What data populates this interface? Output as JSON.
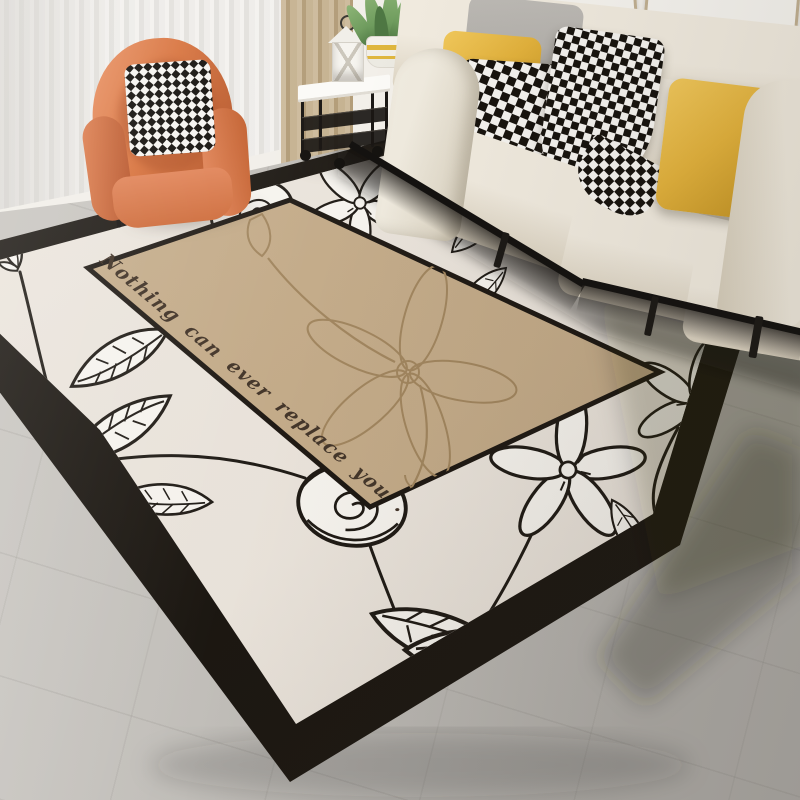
{
  "scene": {
    "subject": "Beige floral area rug styled in a modern living room",
    "type": "product lifestyle photo"
  },
  "rug": {
    "message": "Nothing can ever replace you .",
    "message_color": "#44362a",
    "field_color": "#efe9e1",
    "border_color": "#17130e",
    "panel_color": "#c7ae8b",
    "panel_art_color": "#a3875f",
    "lineart_color": "#1b1712",
    "petal_fill": "#fcfaf5"
  },
  "palette": {
    "wall": "#f2efe9",
    "floor_light": "#cac7c2",
    "floor_dark": "#aeaba6",
    "sheer_curtain": "#eceae6",
    "drape": "#c8b393",
    "sofa": "#e9e2d4",
    "armchair": "#d8743f",
    "armchair_dark": "#b2552a",
    "pillow_yellow": "#e3b23c",
    "pillow_gray": "#b5b2ad",
    "pillow_bw": "#17130e",
    "plant_green": "#6f9c5e",
    "pot_stripe": "#dfb63e",
    "table_metal": "#1b1815",
    "lantern": "#f6f4ef",
    "frame_wood": "#c1b092"
  }
}
